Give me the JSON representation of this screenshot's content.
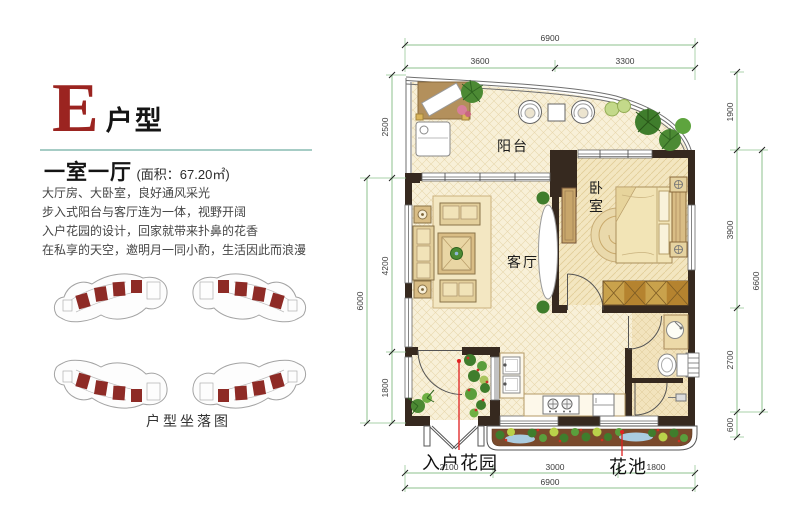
{
  "header": {
    "letter": "E",
    "letter_suffix": "户型",
    "layout": "一室一厅",
    "area": "(面积：67.20㎡)"
  },
  "description": {
    "line1": "大厅房、大卧室，良好通风采光",
    "line2": "步入式阳台与客厅连为一体，视野开阔",
    "line3": "入户花园的设计，回家就带来扑鼻的花香",
    "line4": "在私享的天空，邀明月一同小酌，生活因此而浪漫"
  },
  "sitemap": {
    "caption": "户型坐落图"
  },
  "plan": {
    "labels": {
      "balcony": "阳台",
      "living_room": "客厅",
      "bedroom_char1": "卧",
      "bedroom_char2": "室",
      "entry_garden": "入户花园",
      "flower_bed": "花池"
    },
    "dims": {
      "top_total": "6900",
      "top_left": "3600",
      "top_right": "3300",
      "left_1": "2500",
      "left_2": "4200",
      "left_3": "1800",
      "left_total": "6000",
      "right_1": "1900",
      "right_2": "3900",
      "right_3": "2700",
      "right_4": "600",
      "right_total": "6600",
      "bottom_1": "2100",
      "bottom_2": "3000",
      "bottom_3": "1800",
      "bottom_total": "6900"
    }
  },
  "colors": {
    "accent_red": "#9b2420",
    "unit_highlight_red": "#8e2b26",
    "wall": "#36291f",
    "dim_green": "#8cc08c",
    "leader_red": "#e02020",
    "floor_cream": "#f8f0d8",
    "bedroom_floor": "#f3e6c0"
  }
}
